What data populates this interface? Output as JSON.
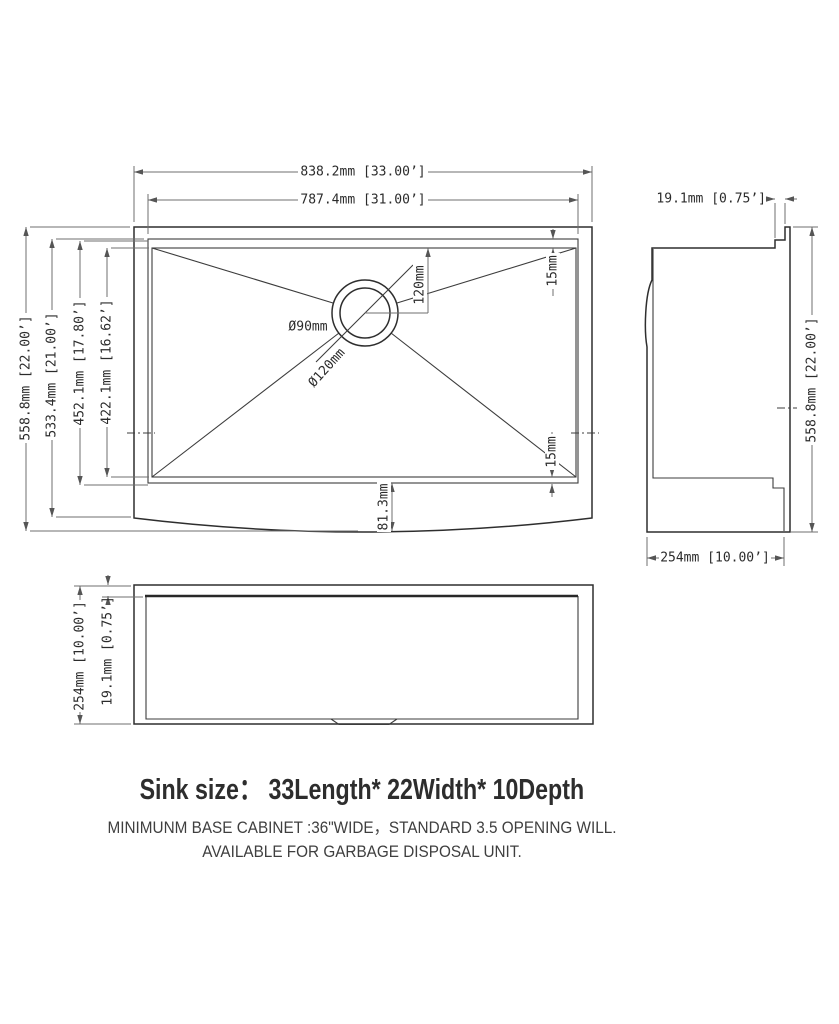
{
  "top_view": {
    "dim_overall_length": "838.2mm [33.00’]",
    "dim_inner_length": "787.4mm [31.00’]",
    "dim_overall_width": "558.8mm [22.00’]",
    "dim_inner_width": "533.4mm [21.00’]",
    "dim_bowl_width_outer": "452.1mm [17.80’]",
    "dim_bowl_width_inner": "422.1mm [16.62’]",
    "dim_drain_offset": "120mm",
    "dim_rim_top": "15mm",
    "dim_rim_bottom": "15mm",
    "dim_apron": "81.3mm",
    "drain_inner": "Ø90mm",
    "drain_outer": "Ø120mm"
  },
  "side_view": {
    "dim_rim": "19.1mm [0.75’]",
    "dim_depth": "558.8mm [22.00’]",
    "dim_height": "254mm [10.00’]"
  },
  "front_view": {
    "dim_height": "254mm [10.00’]",
    "dim_rim": "19.1mm [0.75’]"
  },
  "footer": {
    "title": "Sink size：  33Length* 22Width* 10Depth",
    "note_line1": "MINIMUNM BASE CABINET :36\"WIDE，STANDARD 3.5 OPENING WILL.",
    "note_line2": "AVAILABLE FOR GARBAGE DISPOSAL UNIT."
  }
}
